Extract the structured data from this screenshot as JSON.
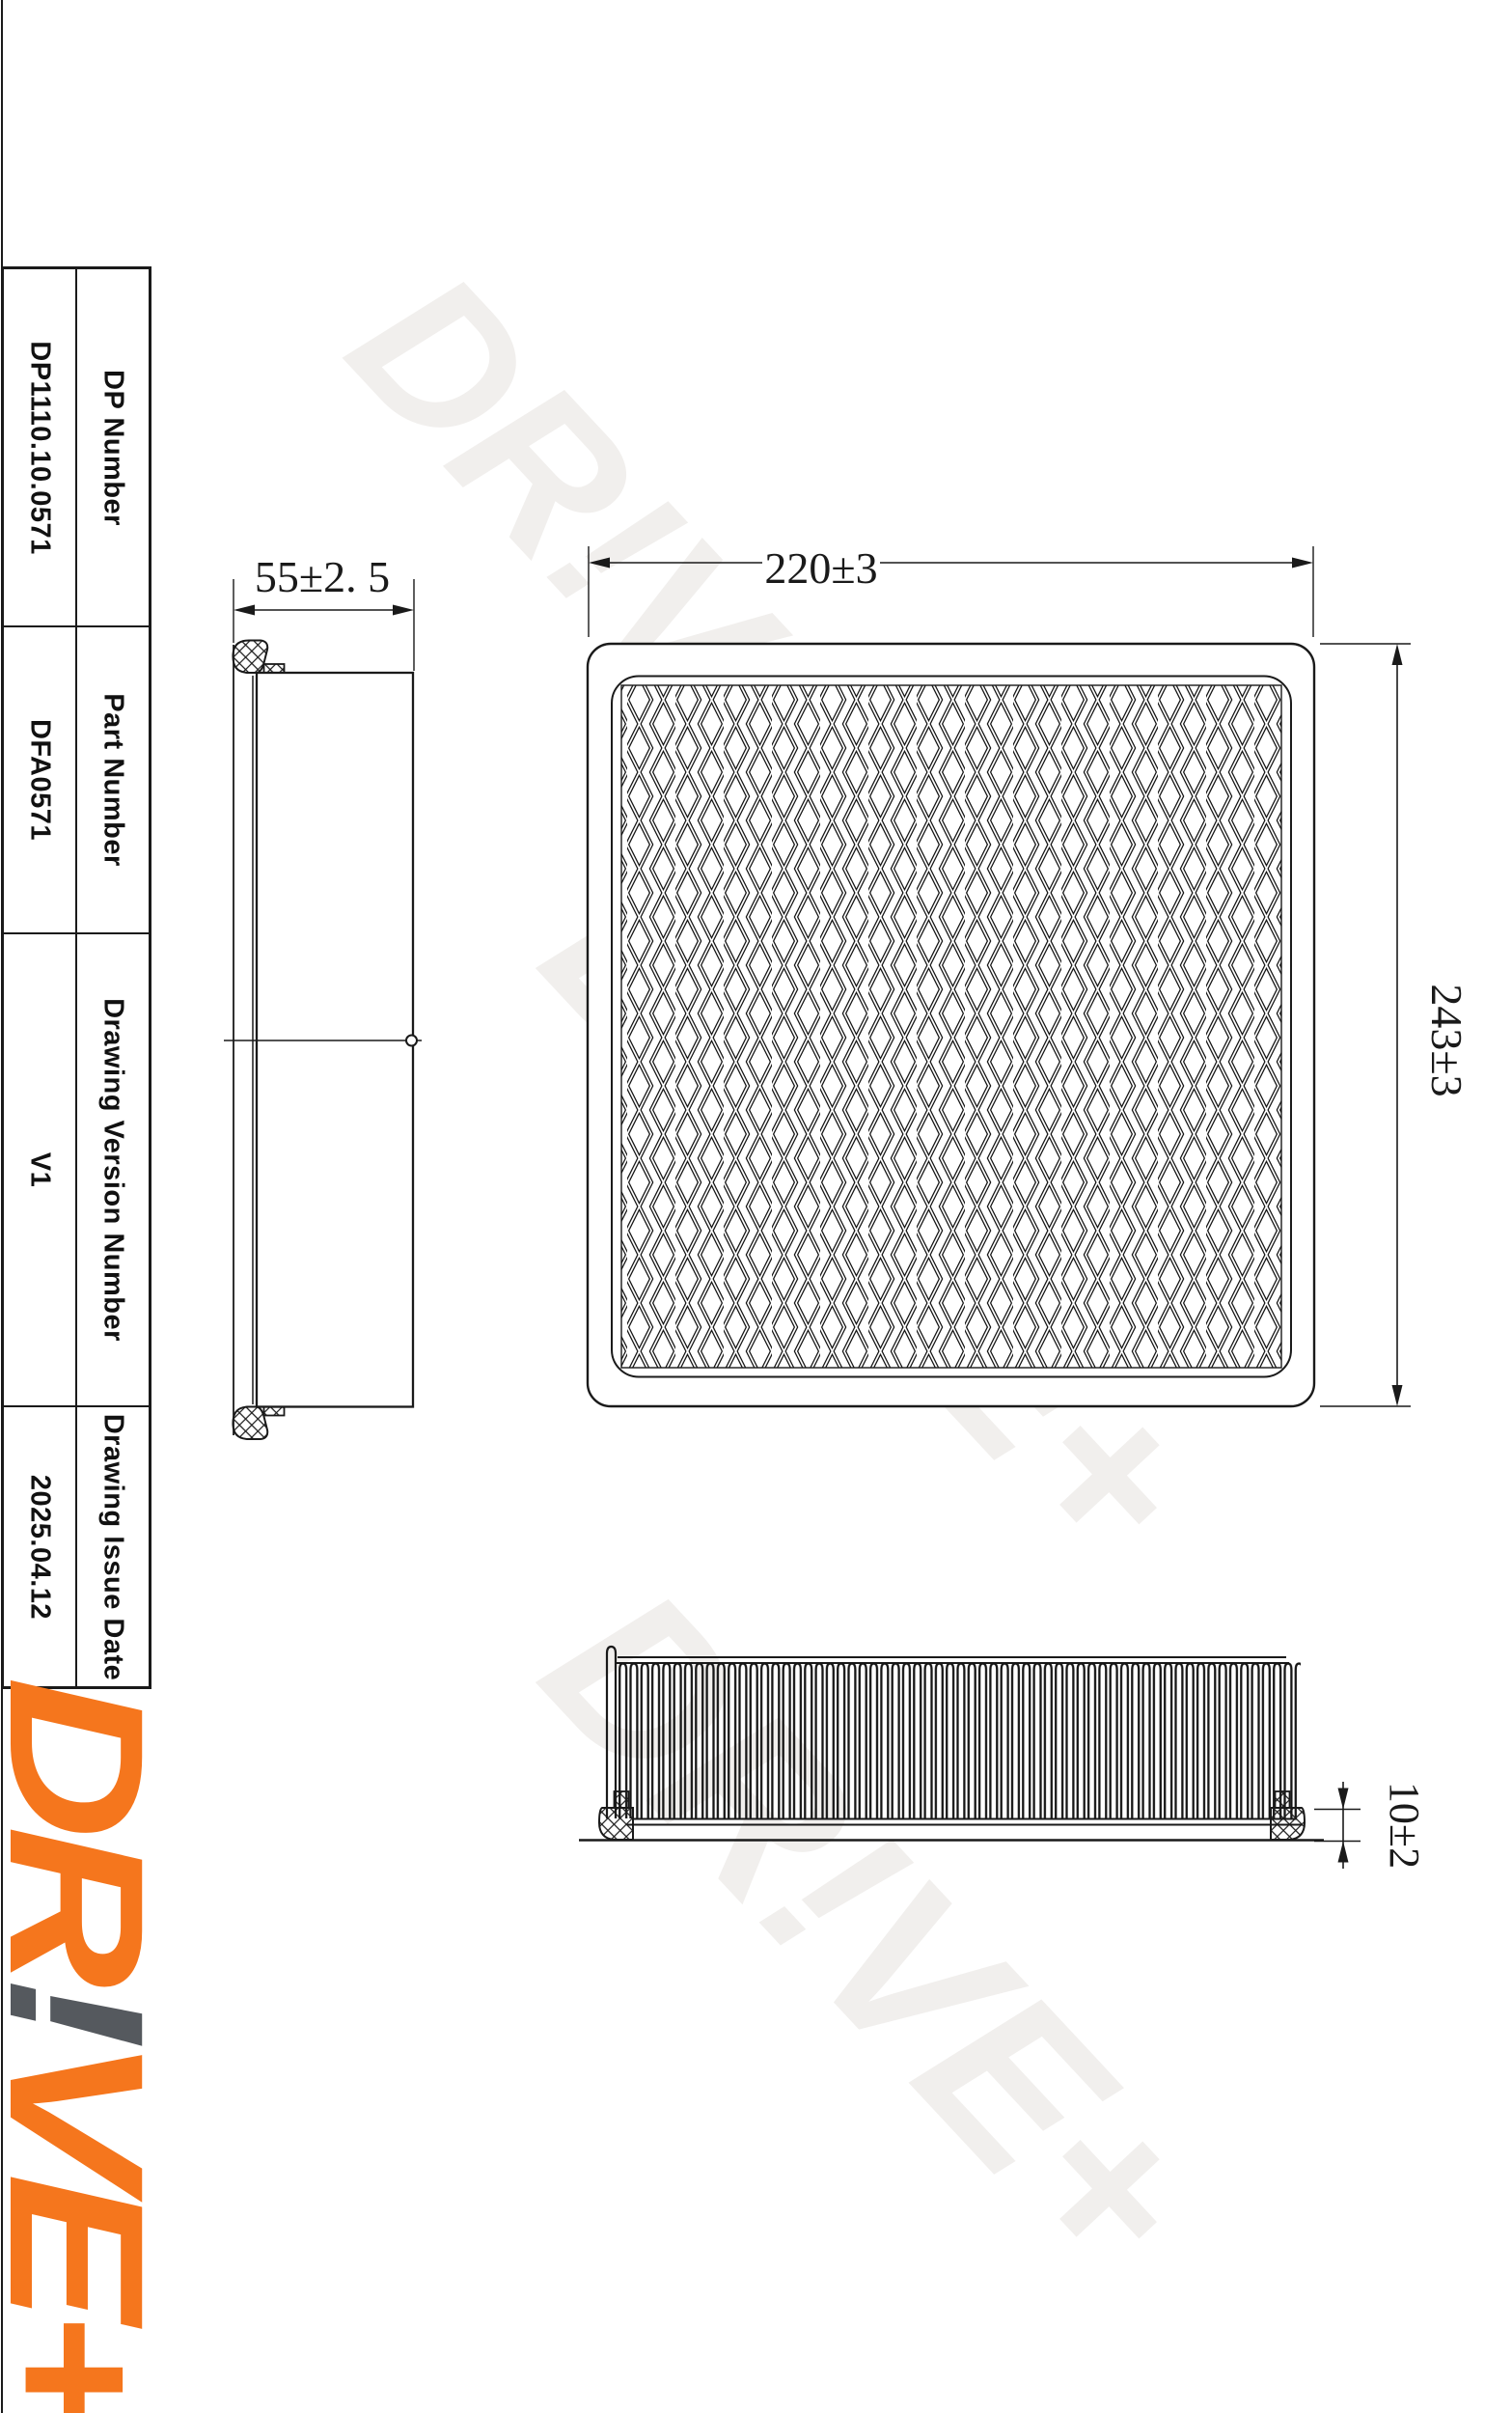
{
  "sidebar": {
    "rows": [
      {
        "label": "DP Number",
        "value": "DP1110.10.0571"
      },
      {
        "label": "Part Number",
        "value": "DFA0571"
      },
      {
        "label": "Drawing Version Number",
        "value": "V1"
      },
      {
        "label": "Drawing Issue Date",
        "value": "2025.04.12"
      }
    ],
    "logo": {
      "prefix": "DR",
      "bang": "!",
      "suffix": "VE+"
    }
  },
  "drawing": {
    "watermark_text": "DR!VE+",
    "dims": {
      "side_width": "55±2. 5",
      "plan_width": "220±3",
      "plan_height": "243±3",
      "tray_height": "10±2"
    },
    "colors": {
      "accent": "#F5761D",
      "bang_gray": "#55595E",
      "line": "#1a1a1a",
      "watermark": "#f1efed"
    }
  }
}
